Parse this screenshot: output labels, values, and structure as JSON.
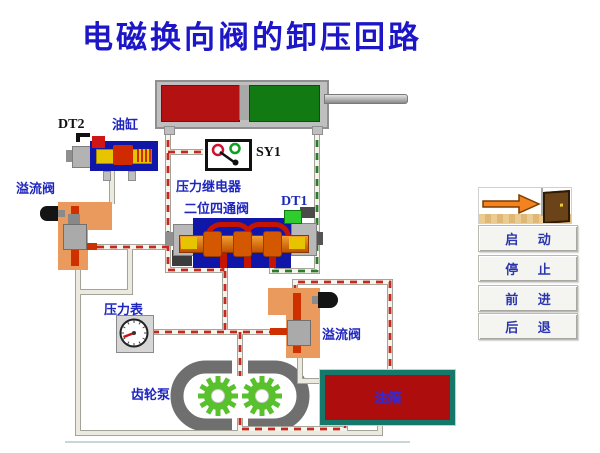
{
  "title": {
    "text": "电磁换向阀的卸压回路",
    "color": "#1c16c6"
  },
  "diagram": {
    "labels": {
      "dt2": "DT2",
      "cylinder": "油缸",
      "sy1": "SY1",
      "pressure_relay": "压力继电器",
      "four_way_valve": "二位四通阀",
      "dt1": "DT1",
      "relief_valve_left": "溢流阀",
      "pressure_gauge": "压力表",
      "gear_pump": "齿轮泵",
      "relief_valve_right": "溢流阀",
      "oil_tank": "油箱"
    },
    "colors": {
      "pressure_line_dash": "#c5281e",
      "return_line_dash": "#2c7a2c",
      "pipe_edge": "#9a9a90",
      "pipe_base": "#f4f4ec",
      "drain_base": "#eceade",
      "cylinder_left_chamber": "#b41212",
      "cylinder_right_chamber": "#127a12",
      "valve_body_blue": "#1016a8",
      "relief_valve_orange": "#eb9a5e",
      "tank_fill": "#ad0d0d",
      "tank_border": "#16776b",
      "gear_green": "#58c12d",
      "label_blue": "#1f26c0"
    }
  },
  "controls": {
    "exit_icon": "exit-door-arrow",
    "buttons": [
      {
        "id": "start",
        "label": "启 动"
      },
      {
        "id": "stop",
        "label": "停 止"
      },
      {
        "id": "forward",
        "label": "前 进"
      },
      {
        "id": "backward",
        "label": "后 退"
      }
    ]
  }
}
